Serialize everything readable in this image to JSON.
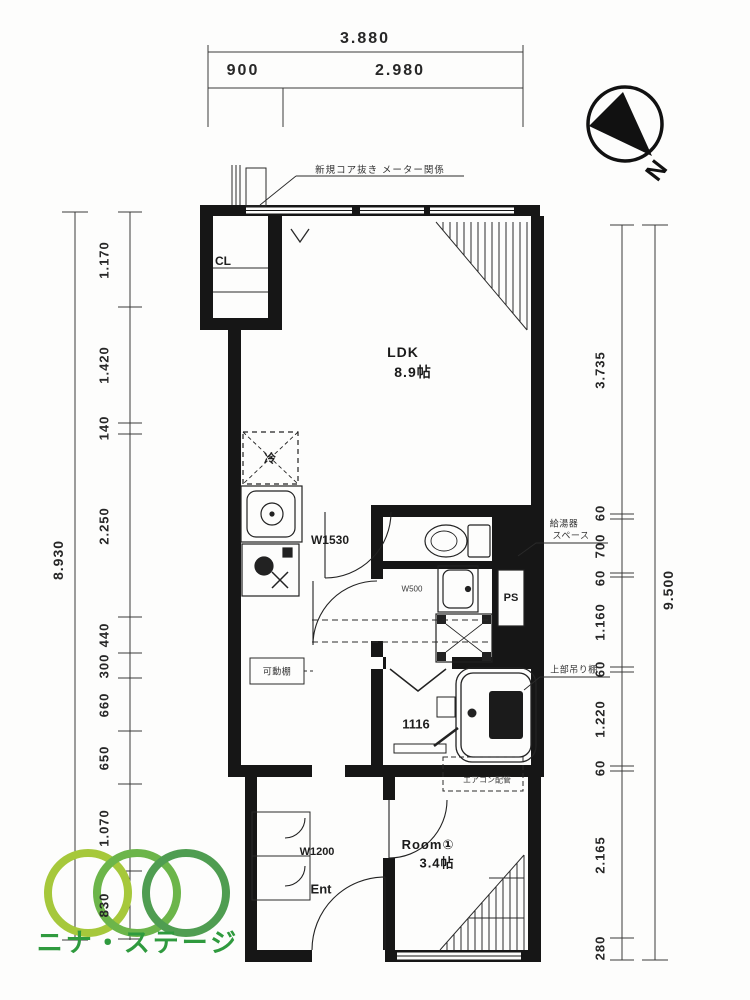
{
  "dimensions": {
    "top": {
      "total": "3.880",
      "segments": [
        "900",
        "2.980"
      ]
    },
    "left": {
      "total": "8.930",
      "segments": [
        "1.170",
        "1.420",
        "140",
        "2.250",
        "440",
        "300",
        "660",
        "650",
        "1.070",
        "830"
      ]
    },
    "right": {
      "total": "9.500",
      "segments": [
        "3.735",
        "60",
        "700",
        "60",
        "1.160",
        "60",
        "1.220",
        "60",
        "2.165",
        "280"
      ]
    }
  },
  "rooms": {
    "ldk": {
      "name": "LDK",
      "size": "8.9帖"
    },
    "room1": {
      "name": "Room①",
      "size": "3.4帖"
    },
    "closet": "CL",
    "entrance": "Ent",
    "pipe_shaft": "PS",
    "fridge": "冷"
  },
  "fixtures": {
    "kitchen_width": "W1530",
    "basin_width": "W500",
    "unit_bath_size": "1116",
    "entrance_width": "W1200"
  },
  "notes": {
    "top": "新規コア抜き メーター関係",
    "water_heater_line1": "給湯器",
    "water_heater_line2": "スペース",
    "upper_shelf": "上部吊り棚",
    "movable_shelf": "可動棚",
    "aircon": "エアコン配管"
  },
  "compass": {
    "label": "N"
  },
  "logo": {
    "company": "ニナ・ステージ",
    "text_color": "#2f9a3e",
    "ring_colors": [
      "#a6c83b",
      "#6cb54a",
      "#4f9d51"
    ]
  }
}
